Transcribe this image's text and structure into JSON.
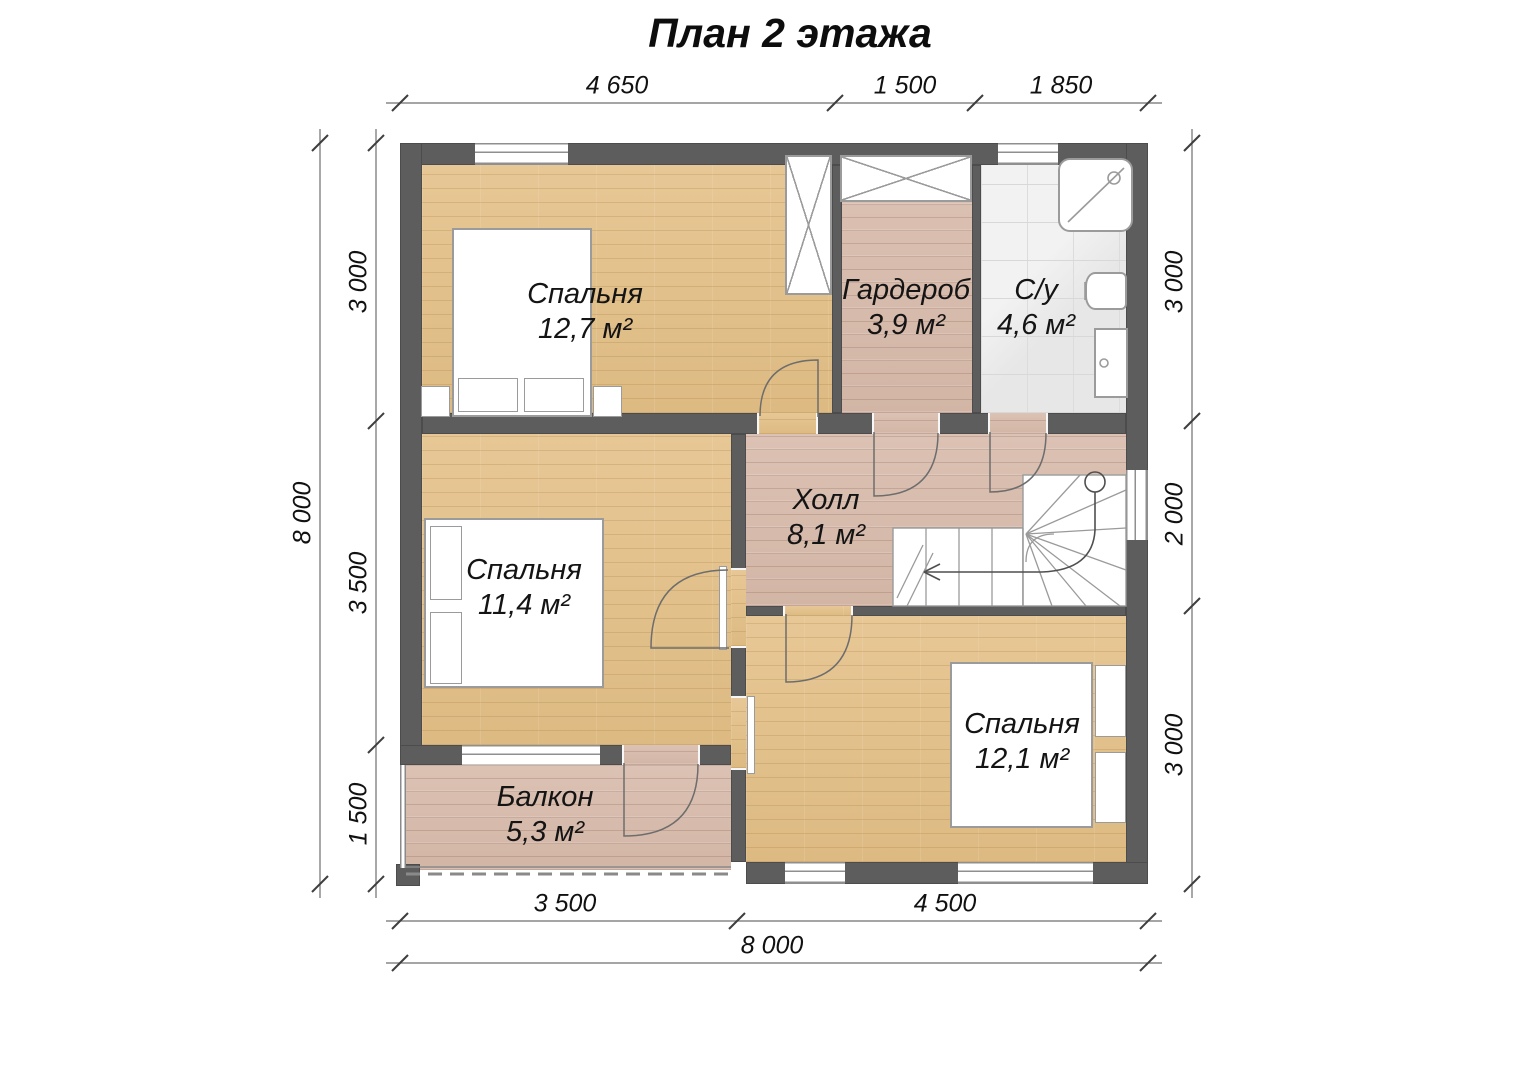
{
  "title": "План 2 этажа",
  "rooms": [
    {
      "name": "Спальня",
      "area": "12,7 м²"
    },
    {
      "name": "Гардероб",
      "area": "3,9 м²"
    },
    {
      "name": "С/у",
      "area": "4,6 м²"
    },
    {
      "name": "Холл",
      "area": "8,1 м²"
    },
    {
      "name": "Спальня",
      "area": "11,4 м²"
    },
    {
      "name": "Спальня",
      "area": "12,1 м²"
    },
    {
      "name": "Балкон",
      "area": "5,3 м²"
    }
  ],
  "dimensions": {
    "top": [
      "4 650",
      "1 500",
      "1 850"
    ],
    "left_outer": "8 000",
    "left_inner": [
      "3 000",
      "3 500",
      "1 500"
    ],
    "right": [
      "3 000",
      "2 000",
      "3 000"
    ],
    "bottom_inner": [
      "3 500",
      "4 500"
    ],
    "bottom_outer": "8 000"
  },
  "colors": {
    "wall": "#5d5d5d",
    "wood_light": "#e3c18f",
    "wood_washed": "#d8bdae",
    "tile": "#ededed",
    "dimension_line": "#6f6f6f"
  }
}
